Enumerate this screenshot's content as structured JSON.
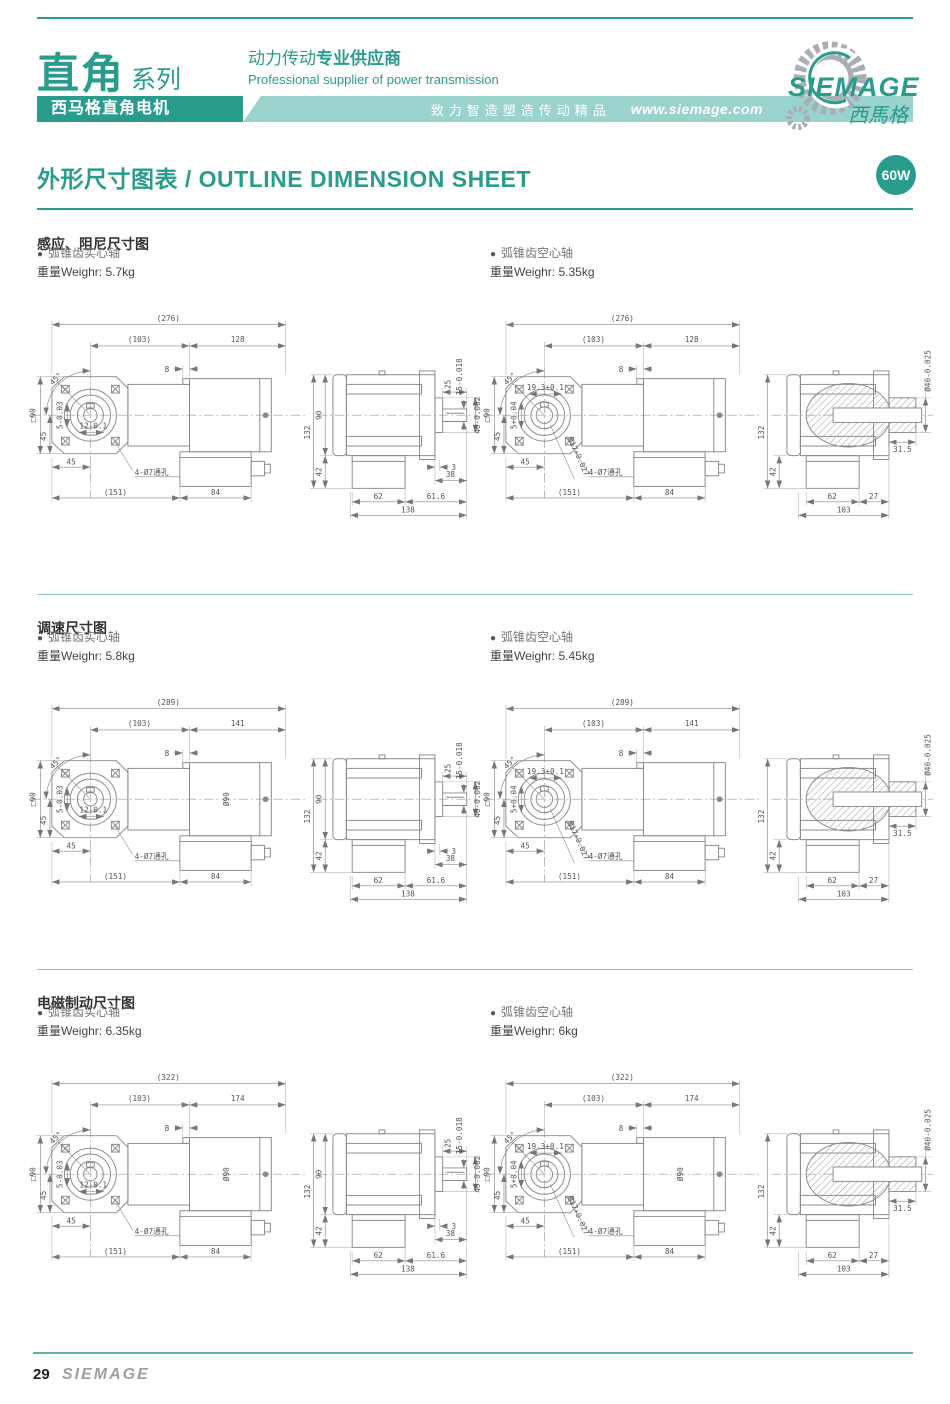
{
  "ui": {
    "bullet": "●"
  },
  "colors": {
    "teal": "#2a9c8e",
    "light_teal": "#99d3cc"
  },
  "header": {
    "series_title": "直角",
    "series_suffix": "系列",
    "series_bar": "西马格直角电机",
    "slogan_cn_regular": "动力传动",
    "slogan_cn_bold": "专业供应商",
    "slogan_en": "Professional supplier of power transmission",
    "strip_motto": "致力智造塑造传动精品",
    "website": "www.siemage.com",
    "logo_name": "SIEMAGE",
    "logo_cn": "西馬格"
  },
  "title": {
    "text": "外形尺寸图表 / OUTLINE DIMENSION SHEET",
    "power_badge": "60W"
  },
  "sections": [
    {
      "heading": "感应、阻尼尺寸图",
      "groups": [
        {
          "shaft_type": "弧锥齿实心轴",
          "weight_label": "重量Weighr: 5.7kg",
          "labels": {
            "total": "(276)",
            "gear": "(103)",
            "motor": "128",
            "offset": "8",
            "flange": "□90",
            "angle": "45°",
            "v45": "45",
            "h45": "45",
            "key_h": "12-0.1",
            "key_w": "5-0.03",
            "holes": "4-Ø7通孔",
            "base": "(151)",
            "tbox": "84",
            "side_h": "132",
            "side_body": "90",
            "side_tbox": "42",
            "shaft_len": "25",
            "shaft_d": "15-0.018",
            "spigot_d": "40-0.062",
            "gap": "3",
            "rear": "38",
            "b62": "62",
            "b616": "61.6",
            "b138": "138"
          }
        },
        {
          "shaft_type": "弧锥齿空心轴",
          "weight_label": "重量Weighr: 5.35kg",
          "labels": {
            "total": "(276)",
            "gear": "(103)",
            "motor": "128",
            "offset": "8",
            "flange": "□90",
            "angle": "45°",
            "v45": "45",
            "h45": "45",
            "bore_h": "19.3+0.1",
            "key_w": "5+0.04",
            "bore_d": "Ø17+0.027",
            "holes": "4-Ø7通孔",
            "base": "(151)",
            "tbox": "84",
            "side_h": "132",
            "side_tbox": "42",
            "hub_d": "Ø40-0.025",
            "hub_len": "31.5",
            "b62": "62",
            "b27": "27",
            "b103": "103"
          }
        }
      ]
    },
    {
      "heading": "调速尺寸图",
      "groups": [
        {
          "shaft_type": "弧锥齿实心轴",
          "weight_label": "重量Weighr: 5.8kg",
          "labels": {
            "total": "(289)",
            "gear": "(103)",
            "motor": "141",
            "offset": "8",
            "flange": "□90",
            "angle": "45°",
            "v45": "45",
            "h45": "45",
            "key_h": "12-0.1",
            "key_w": "5-0.03",
            "holes": "4-Ø7通孔",
            "base": "(151)",
            "tbox": "84",
            "body_d": "Ø90",
            "side_h": "132",
            "side_body": "90",
            "side_tbox": "42",
            "shaft_len": "25",
            "shaft_d": "15-0.018",
            "spigot_d": "40-0.062",
            "gap": "3",
            "rear": "38",
            "b62": "62",
            "b616": "61.6",
            "b138": "138"
          }
        },
        {
          "shaft_type": "弧锥齿空心轴",
          "weight_label": "重量Weighr: 5.45kg",
          "labels": {
            "total": "(289)",
            "gear": "(103)",
            "motor": "141",
            "offset": "8",
            "flange": "□90",
            "angle": "45°",
            "v45": "45",
            "h45": "45",
            "bore_h": "19.3+0.1",
            "key_w": "5+0.04",
            "bore_d": "Ø17+0.027",
            "holes": "4-Ø7通孔",
            "base": "(151)",
            "tbox": "84",
            "side_h": "132",
            "side_tbox": "42",
            "hub_d": "Ø40-0.025",
            "hub_len": "31.5",
            "b62": "62",
            "b27": "27",
            "b103": "103"
          }
        }
      ]
    },
    {
      "heading": "电磁制动尺寸图",
      "groups": [
        {
          "shaft_type": "弧锥齿实心轴",
          "weight_label": "重量Weighr: 6.35kg",
          "labels": {
            "total": "(322)",
            "gear": "(103)",
            "motor": "174",
            "offset": "8",
            "flange": "□90",
            "angle": "45°",
            "v45": "45",
            "h45": "45",
            "key_h": "12-0.1",
            "key_w": "5-0.03",
            "holes": "4-Ø7通孔",
            "base": "(151)",
            "tbox": "84",
            "body_d": "Ø90",
            "side_h": "132",
            "side_body": "90",
            "side_tbox": "42",
            "shaft_len": "25",
            "shaft_d": "15-0.018",
            "spigot_d": "40-0.062",
            "gap": "3",
            "rear": "38",
            "b62": "62",
            "b616": "61.6",
            "b138": "138"
          }
        },
        {
          "shaft_type": "弧锥齿空心轴",
          "weight_label": "重量Weighr: 6kg",
          "labels": {
            "total": "(322)",
            "gear": "(103)",
            "motor": "174",
            "offset": "8",
            "flange": "□90",
            "angle": "45°",
            "v45": "45",
            "h45": "45",
            "bore_h": "19.3+0.1",
            "key_w": "5+0.04",
            "bore_d": "Ø17+0.027",
            "holes": "4-Ø7通孔",
            "base": "(151)",
            "tbox": "84",
            "body_d": "Ø90",
            "side_h": "132",
            "side_tbox": "42",
            "hub_d": "Ø40-0.025",
            "hub_len": "31.5",
            "b62": "62",
            "b27": "27",
            "b103": "103"
          }
        }
      ]
    }
  ],
  "footer": {
    "page_number": "29",
    "brand": "SIEMAGE"
  }
}
